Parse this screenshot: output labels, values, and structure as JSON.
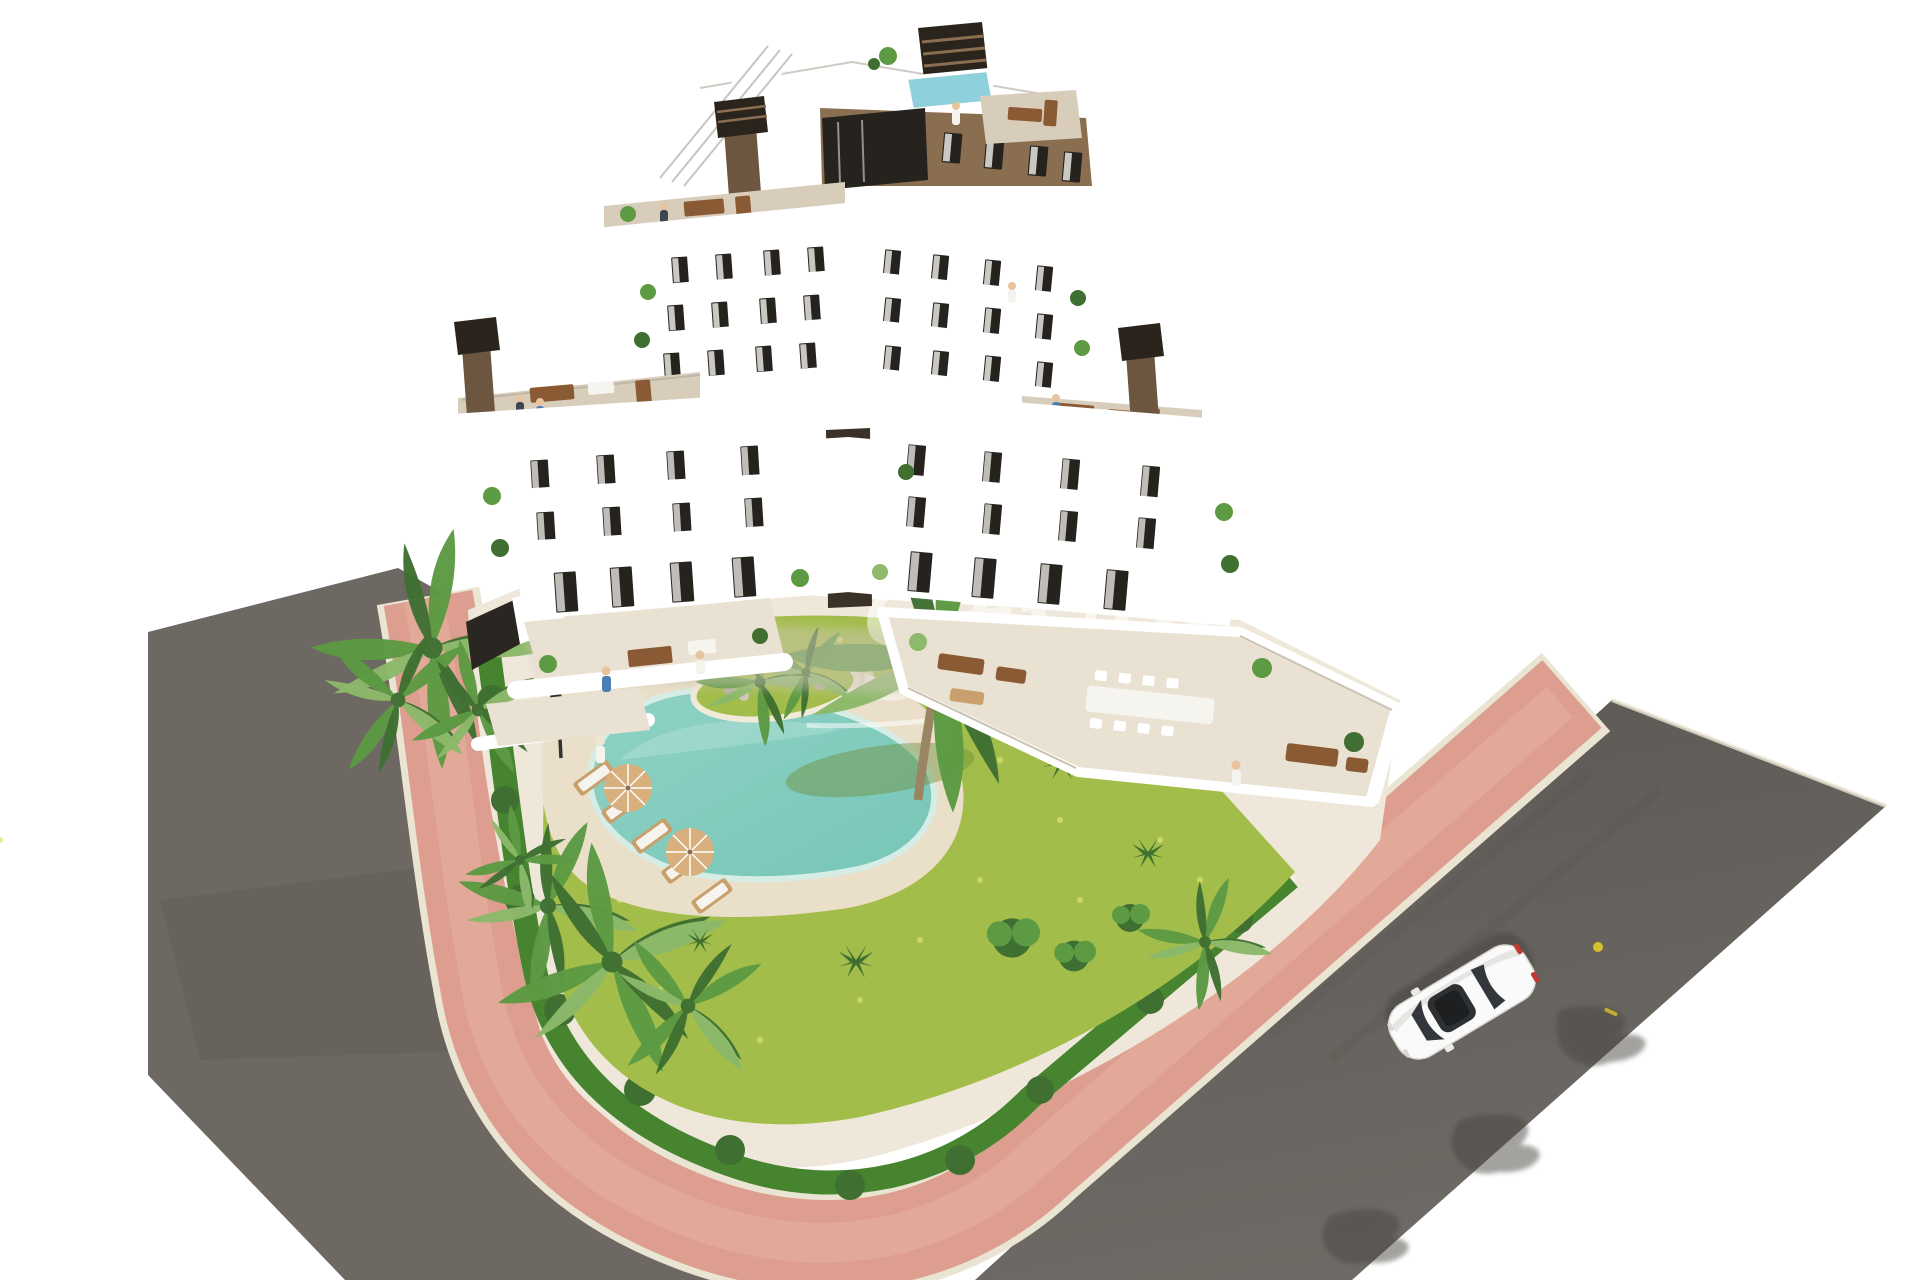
{
  "watermark": {
    "brand_script": "Style",
    "brand_subtitle": "PREMIUM"
  },
  "scene": {
    "description": "Aerial 3D architectural render of a modern stepped apartment building with white curved balcony bands and brown facade, rooftop terraces, landscaped garden with lagoon-style pool, pink sidewalks, asphalt streets and a single white car",
    "objects": [
      "apartment-building",
      "rooftop-terrace",
      "rooftop-plunge-pool",
      "roof-staircase",
      "chimneys",
      "balcony-bands",
      "ground-floor-terraces",
      "walled-corner-terrace",
      "landscaped-garden",
      "lagoon-pool",
      "sand-beach",
      "pool-island",
      "sun-loungers",
      "parasols",
      "palm-trees",
      "hedge",
      "garden-lamp",
      "residents",
      "pink-sidewalk",
      "asphalt-road-left",
      "asphalt-road-right",
      "white-car",
      "brand-watermark"
    ]
  },
  "colors": {
    "background": "#ffffff",
    "facade": "#8a6e50",
    "facade_shadow": "#6d563f",
    "glass": "#26231e",
    "curtain": "#f4f1ec",
    "terrace": "#d8cdbb",
    "terrace_light": "#e9e1d2",
    "roof_pool": "#8fd0dd",
    "chimney_dark": "#2b241d",
    "grass": "#a3bd4b",
    "grass_speckle": "#dbe070",
    "hedge": "#47842f",
    "palm_dark": "#3f7032",
    "palm_mid": "#5c9a43",
    "palm_light": "#8cb96a",
    "pool_water": "#8fd2c5",
    "pool_deep": "#76c6b8",
    "pool_rim": "#d6ede5",
    "sand": "#eadfc8",
    "plot_ground": "#efe8da",
    "sidewalk": "#dd9e8f",
    "sidewalk_light": "#e8b4a5",
    "curb": "#eae4d2",
    "road_left": "#6e6862",
    "road_right": "#64605b",
    "road_shadow": "#4a4642",
    "car_body": "#fafafa",
    "car_glass": "#33363a",
    "car_tail": "#c23a2e",
    "road_mark_yellow": "#d6c12c",
    "wood": "#8a5a34",
    "wood_light": "#c9a06c",
    "cushion": "#f6f4ef",
    "parasol": "#d7b07e",
    "person_blue": "#4a7fb5",
    "person_skin": "#e8c49e",
    "person_white": "#f5f3ee",
    "person_dark": "#3c4650",
    "watermark_color": "rgba(255,255,255,0.55)"
  }
}
